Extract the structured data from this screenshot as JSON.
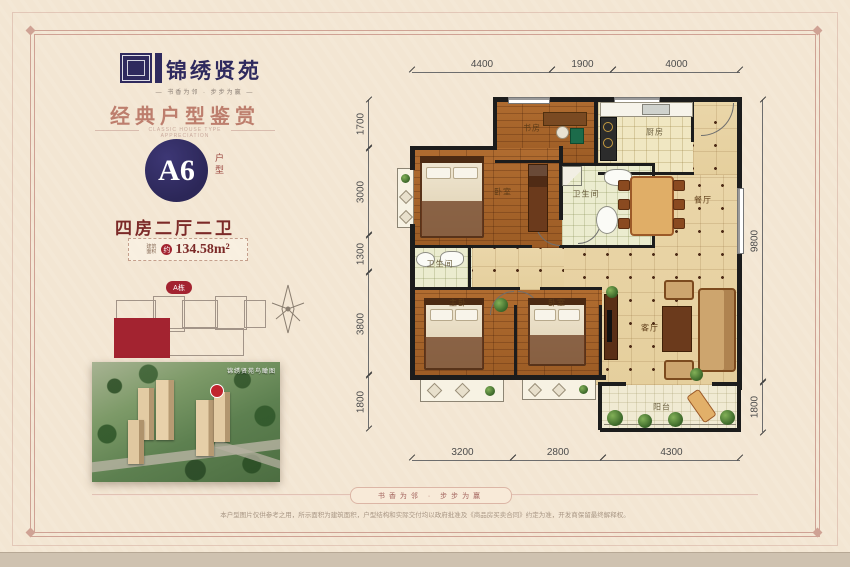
{
  "brand": {
    "name": "锦绣贤苑",
    "tagline": "— 书香为邻 · 步步为赢 —"
  },
  "header": {
    "title": "经典户型鉴赏",
    "subtitle": "CLASSIC HOUSE TYPE APPRECIATION"
  },
  "unit": {
    "code": "A6",
    "code_label": "户型",
    "rooms": "四房二厅二卫",
    "area_label": "建筑面积",
    "area_circle": "约",
    "area_value": "134.58m²"
  },
  "site": {
    "badge": "A栋",
    "aerial_caption": "锦绣贤苑鸟瞰图"
  },
  "plan": {
    "labels": {
      "study": "书房",
      "kitchen": "厨房",
      "bath1": "卫生间",
      "bedroom_top": "卧室",
      "dining": "餐厅",
      "bath2": "卫生间",
      "master": "主卧",
      "bedroom2": "卧室",
      "living": "客厅",
      "balcony": "阳台"
    },
    "dims": {
      "top": [
        "4400",
        "1900",
        "4000"
      ],
      "left": [
        "1700",
        "3000",
        "1300",
        "3800",
        "1800"
      ],
      "right": [
        "9800",
        "1800"
      ],
      "bottom": [
        "3200",
        "2800",
        "4300"
      ]
    }
  },
  "footer": {
    "ribbon": "书香为邻 · 步步为赢",
    "disclaimer": "本户型图片仅供参考之用，所示面积为建筑面积，户型结构和实际交付均以政府批准及《商品房买卖合同》约定为准，开发商保留最终解释权。"
  },
  "colors": {
    "navy": "#2f2a5e",
    "maroon": "#7c2a28",
    "rose": "#bd7e6d",
    "badge_red": "#a32330"
  }
}
